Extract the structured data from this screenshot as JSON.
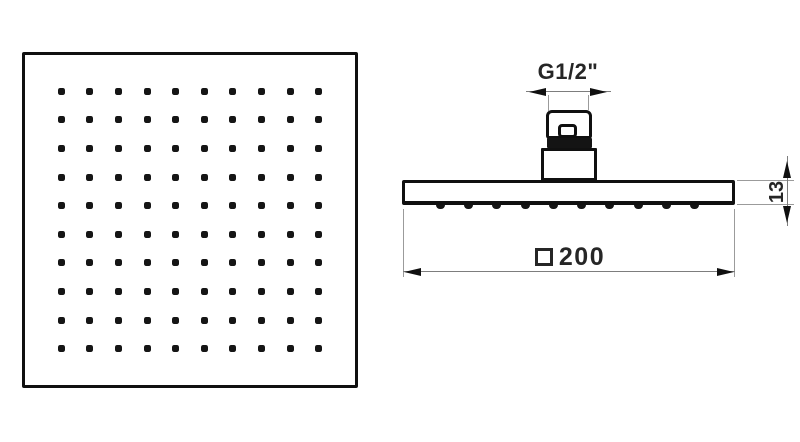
{
  "diagram": {
    "type": "technical-drawing",
    "subject": "square-rain-shower-head",
    "colors": {
      "outline": "#101010",
      "dimension_line": "#7d7d7d",
      "extension_line": "#9b9b9b",
      "text": "#262626",
      "background": "#ffffff"
    },
    "top_view": {
      "spray_grid": {
        "rows": 10,
        "cols": 10
      }
    },
    "side_view": {
      "nozzle_count": 10,
      "dimensions": {
        "thread": {
          "label": "G1/2\""
        },
        "thickness": {
          "value": "13"
        },
        "width": {
          "symbol": "□",
          "value": "200"
        }
      }
    }
  }
}
